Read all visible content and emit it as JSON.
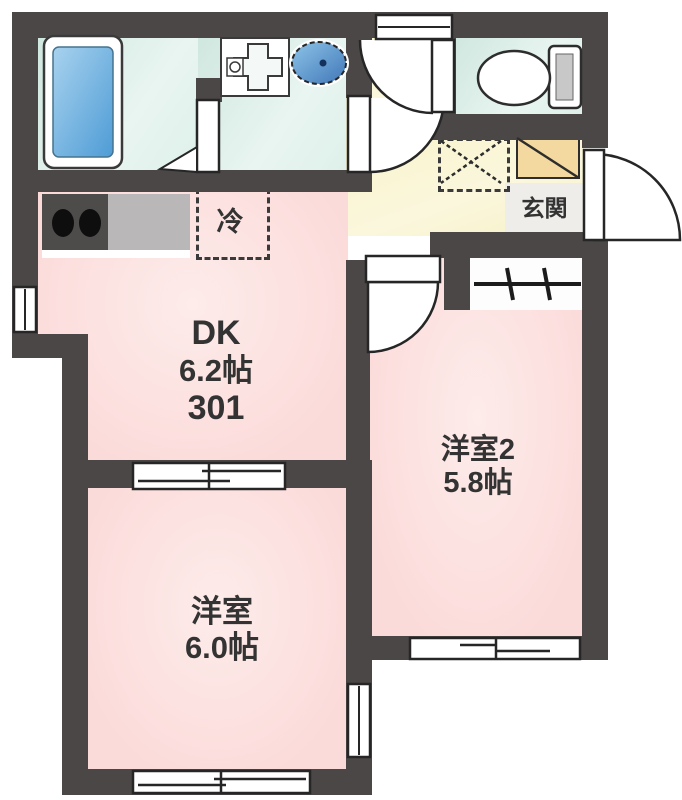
{
  "rooms": {
    "dk": {
      "name": "DK",
      "size": "6.2帖",
      "room_number": "301"
    },
    "western_room_2": {
      "name": "洋室2",
      "size": "5.8帖"
    },
    "western_room_1": {
      "name": "洋室",
      "size": "6.0帖"
    },
    "entrance": {
      "name": "玄関"
    }
  },
  "fixtures": {
    "refrigerator_space": {
      "label": "冷"
    },
    "icon_names": [
      "bathtub-icon",
      "vanity-unit-icon",
      "wash-basin-icon",
      "toilet-icon",
      "stove-burners-icon",
      "kitchen-counter",
      "washing-machine-space-icon",
      "shoe-cabinet-icon",
      "hanger-pole-icon",
      "door-swing-icon",
      "sliding-door-icon",
      "window-icon"
    ]
  },
  "colors": {
    "wall": "#4b4747",
    "room_pink": "#fbdcdb",
    "wet_area_teal": "#d7eae3",
    "hall_yellow": "#f8f3cd",
    "shoe_cabinet_tan": "#f3d99f",
    "bathtub_blue": "#5ca3d8",
    "wash_basin_blue": "#5ca3d8",
    "counter_gray": "#b9b7b7",
    "stove_dark_gray": "#4e4b4b",
    "entrance_step_gray": "#efede9",
    "outline": "#262626"
  }
}
